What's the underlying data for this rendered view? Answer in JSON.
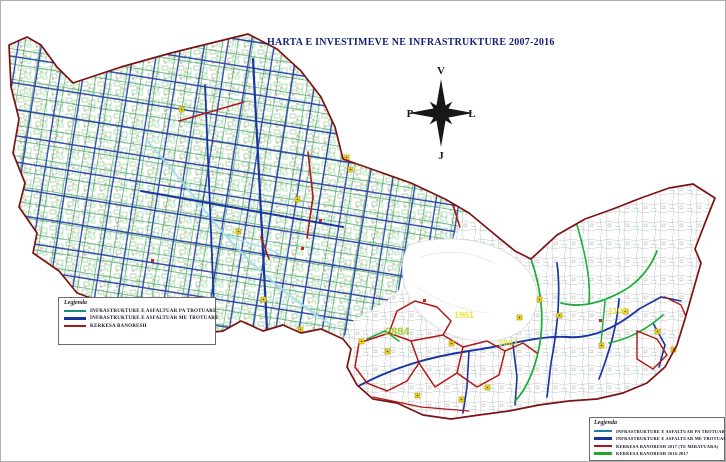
{
  "title": "HARTA E INVESTIMEVE NE INFRASTRUKTURE 2007-2016",
  "compass": {
    "north": "V",
    "south": "J",
    "east": "L",
    "west": "P"
  },
  "legend_left": {
    "title": "Legjenda",
    "items": [
      {
        "label": "INFRASTRUKTURE E ASFALTUAR PA TROTUARE",
        "color": "#18927c"
      },
      {
        "label": "INFRASTRUKTURE E ASFALTUAR ME TROTUARE",
        "color": "#16339e"
      },
      {
        "label": "KERKESA BANORESH",
        "color": "#a01818"
      }
    ]
  },
  "legend_right": {
    "title": "Legjenda",
    "items": [
      {
        "label": "INFRASTRUKTURE E ASFALTUAR PA TROTUARE TE MIRE",
        "color": "#1a7fa0"
      },
      {
        "label": "INFRASTRUKTURE E ASFALTUAR ME TROTUARE",
        "color": "#16339e"
      },
      {
        "label": "KERKESA BANORESH 2017 (TE MIRATUARA)",
        "color": "#a01818"
      },
      {
        "label": "KERKESA BANORESH 2016-2017",
        "color": "#23a82e"
      }
    ]
  },
  "map_labels": [
    {
      "text": "2884",
      "color": "#9ccf2e"
    },
    {
      "text": "1961",
      "color": "#ede23c"
    },
    {
      "text": "3067",
      "color": "#ede23c"
    },
    {
      "text": "1100",
      "color": "#ede23c"
    }
  ],
  "map_colors": {
    "boundary": "#7c1212",
    "street_with_sidewalk": "#1b35a0",
    "street_no_sidewalk": "#2f9158",
    "resident_request": "#b01818",
    "resident_request_2016": "#1fae3a",
    "water": "#a5dde9",
    "poi_marker": "#f2df1f"
  }
}
